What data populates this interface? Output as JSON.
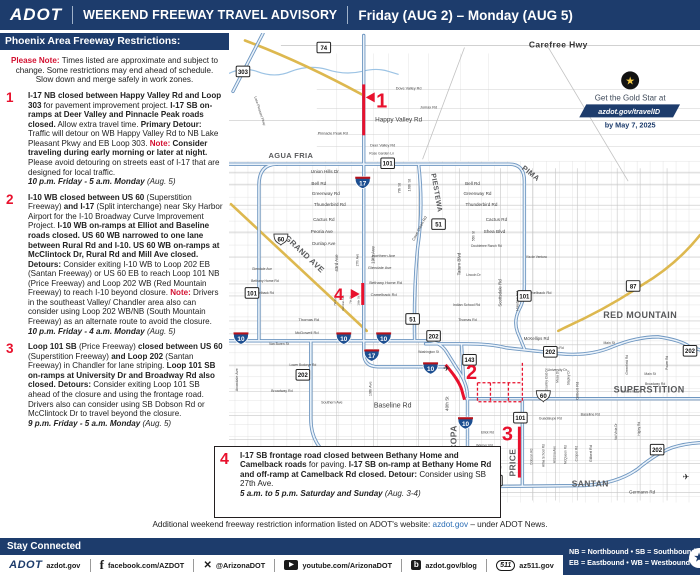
{
  "colors": {
    "navy": "#1d3c6c",
    "red": "#d31232",
    "marker_red": "#e8112d",
    "link_blue": "#2a6db5",
    "freeway_blue": "#6e96c0",
    "yellow_road": "#ddb84f",
    "interstate_blue": "#1d4f91"
  },
  "header": {
    "logo": "ADOT",
    "title": "WEEKEND FREEWAY TRAVEL ADVISORY",
    "dates": "Friday (AUG 2) – Monday (AUG 5)"
  },
  "panel": {
    "title": "Phoenix Area Freeway Restrictions:",
    "note": [
      {
        "t": "Please Note: ",
        "s": "rb"
      },
      {
        "t": "Times listed are approximate and subject to change. Some restrictions may end ahead of schedule. Slow down and merge safely in work zones.",
        "s": "n"
      }
    ],
    "items": [
      {
        "num": "1",
        "segments": [
          {
            "t": "I-17 NB closed between Happy Valley Rd and Loop 303",
            "s": "b"
          },
          {
            "t": " for pavement improvement project. ",
            "s": "n"
          },
          {
            "t": "I-17 SB on-ramps at Deer Valley and Pinnacle Peak roads closed.",
            "s": "b"
          },
          {
            "t": " Allow extra travel time. ",
            "s": "n"
          },
          {
            "t": "Primary Detour:",
            "s": "b"
          },
          {
            "t": " Traffic will detour on WB Happy Valley Rd to NB Lake Pleasant Pkwy and EB Loop 303. ",
            "s": "n"
          },
          {
            "t": "Note:",
            "s": "rb"
          },
          {
            "t": " ",
            "s": "n"
          },
          {
            "t": "Consider traveling during early morning or later at night.",
            "s": "b"
          },
          {
            "t": " Please avoid detouring on streets east of I-17 that are designed for local traffic.",
            "s": "n"
          },
          {
            "br": true
          },
          {
            "t": "10 p.m. Friday - 5 a.m. Monday",
            "s": "ib"
          },
          {
            "t": " (Aug. 5)",
            "s": "i"
          }
        ]
      },
      {
        "num": "2",
        "segments": [
          {
            "t": "I-10 WB closed between US 60",
            "s": "b"
          },
          {
            "t": " (Superstition Freeway) ",
            "s": "n"
          },
          {
            "t": "and I-17",
            "s": "b"
          },
          {
            "t": " (Split interchange) near Sky Harbor Airport for the I-10 Broadway Curve Improvement Project. ",
            "s": "n"
          },
          {
            "t": "I-10 WB on-ramps at Elliot and Baseline roads closed. US 60 WB narrowed to one lane between Rural Rd and I-10. US 60 WB on-ramps at McClintock Dr, Rural Rd and Mill Ave closed. Detours:",
            "s": "b"
          },
          {
            "t": " Consider exiting I-10 WB to Loop 202 EB (Santan Freeway) or US 60 EB to reach Loop 101 NB (Price Freeway) and Loop 202 WB (Red Mountain Freeway) to reach I-10 beyond closure. ",
            "s": "n"
          },
          {
            "t": "Note:",
            "s": "rb"
          },
          {
            "t": " Drivers in the southeast Valley/ Chandler area also can consider using Loop 202 WB/NB (South Mountain Freeway) as an alternate route to avoid the closure.",
            "s": "n"
          },
          {
            "br": true
          },
          {
            "t": "10 p.m. Friday - 4 a.m. Monday",
            "s": "ib"
          },
          {
            "t": " (Aug. 5)",
            "s": "i"
          }
        ]
      },
      {
        "num": "3",
        "segments": [
          {
            "t": "Loop 101 SB",
            "s": "b"
          },
          {
            "t": " (Price Freeway) ",
            "s": "n"
          },
          {
            "t": "closed between US 60",
            "s": "b"
          },
          {
            "t": " (Superstition Freeway) ",
            "s": "n"
          },
          {
            "t": "and Loop 202",
            "s": "b"
          },
          {
            "t": " (Santan Freeway) in Chandler for lane striping. ",
            "s": "n"
          },
          {
            "t": "Loop 101 SB on-ramps at University Dr and Broadway Rd also closed. ",
            "s": "b"
          },
          {
            "t": "Detours:",
            "s": "b"
          },
          {
            "t": " Consider exiting Loop 101 SB ahead of the closure and using the frontage road. Drivers also can consider using SB Dobson Rd or McClintock Dr to travel beyond the closure.",
            "s": "n"
          },
          {
            "br": true
          },
          {
            "t": "9 p.m. Friday - 5 a.m. Monday",
            "s": "ib"
          },
          {
            "t": " (Aug. 5)",
            "s": "i"
          }
        ]
      }
    ]
  },
  "map": {
    "callout4": {
      "num": "4",
      "segments": [
        {
          "t": "I-17 SB frontage road closed between Bethany Home and Camelback roads",
          "s": "b"
        },
        {
          "t": " for paving. ",
          "s": "n"
        },
        {
          "t": "I-17 SB on-ramp at Bethany Home Rd and off-ramp at Camelback Rd closed. Detour:",
          "s": "b"
        },
        {
          "t": " Consider using SB 27th Ave.",
          "s": "n"
        },
        {
          "br": true
        },
        {
          "t": "5 a.m. to 5 p.m. Saturday and Sunday",
          "s": "ib"
        },
        {
          "t": " (Aug. 3-4)",
          "s": "i"
        }
      ]
    },
    "goldstar": {
      "star": "★",
      "line1": "Get the Gold Star at",
      "line2": "azdot.gov/travelID",
      "line3": "by May 7, 2025"
    },
    "freeway_names": [
      {
        "t": "Carefree Hwy",
        "x": 330,
        "y": 14,
        "fs": 8.5,
        "c": "#333333"
      },
      {
        "t": "AGUA FRIA",
        "x": 62,
        "y": 125,
        "fs": 7.5
      },
      {
        "t": "PIMA",
        "x": 301,
        "y": 142,
        "r": 38,
        "fs": 7.5
      },
      {
        "t": "PIESTEWA",
        "x": 206,
        "y": 160,
        "r": 80,
        "fs": 7
      },
      {
        "t": "RED MOUNTAIN",
        "x": 412,
        "y": 285,
        "fs": 9
      },
      {
        "t": "SUPERSTITION",
        "x": 421,
        "y": 360,
        "fs": 9
      },
      {
        "t": "SANTAN",
        "x": 362,
        "y": 454,
        "fs": 8.5
      },
      {
        "t": "MARICOPA",
        "x": 228,
        "y": 417,
        "r": -90,
        "fs": 8.5
      },
      {
        "t": "PRICE",
        "x": 287,
        "y": 430,
        "r": -90,
        "fs": 8.5
      },
      {
        "t": "GRAND AVE",
        "x": 74,
        "y": 223,
        "r": 43,
        "fs": 8
      }
    ],
    "street_labels": [
      {
        "t": "Dove Valley Rd",
        "x": 180,
        "y": 56,
        "fs": 3.8
      },
      {
        "t": "Jomax Rd",
        "x": 200,
        "y": 75,
        "fs": 3.8
      },
      {
        "t": "Happy Valley Rd",
        "x": 170,
        "y": 88,
        "fs": 6.4
      },
      {
        "t": "Pinnacle Peak Rd",
        "x": 104,
        "y": 101,
        "fs": 3.8
      },
      {
        "t": "Deer Valley Rd",
        "x": 154,
        "y": 113,
        "fs": 3.8
      },
      {
        "t": "Rose Garden Ln",
        "x": 153,
        "y": 121,
        "fs": 3.4
      },
      {
        "t": "Lake Pleasant Pkwy",
        "x": 30,
        "y": 78,
        "r": 72,
        "fs": 3.4
      },
      {
        "t": "Union Hills Dr",
        "x": 96,
        "y": 140,
        "fs": 4.6
      },
      {
        "t": "Bell Rd",
        "x": 90,
        "y": 152,
        "fs": 4.6
      },
      {
        "t": "Greenway Rd",
        "x": 97,
        "y": 162,
        "fs": 4.6
      },
      {
        "t": "Thunderbird Rd",
        "x": 101,
        "y": 173,
        "fs": 4.6
      },
      {
        "t": "Cactus Rd",
        "x": 95,
        "y": 188,
        "fs": 4.6
      },
      {
        "t": "Peoria Ave",
        "x": 93,
        "y": 200,
        "fs": 4.6
      },
      {
        "t": "Dunlap Ave",
        "x": 95,
        "y": 212,
        "fs": 4.6
      },
      {
        "t": "Bell Rd",
        "x": 244,
        "y": 152,
        "fs": 4.6
      },
      {
        "t": "Greenway Rd",
        "x": 249,
        "y": 162,
        "fs": 4.6
      },
      {
        "t": "Thunderbird Rd",
        "x": 253,
        "y": 173,
        "fs": 4.6
      },
      {
        "t": "Cactus Rd",
        "x": 268,
        "y": 188,
        "fs": 4.6
      },
      {
        "t": "Shea Blvd",
        "x": 266,
        "y": 200,
        "fs": 4.8
      },
      {
        "t": "Doubletree Ranch Rd",
        "x": 258,
        "y": 214,
        "fs": 3.2
      },
      {
        "t": "Via de Ventura",
        "x": 308,
        "y": 225,
        "fs": 3.2
      },
      {
        "t": "Lincoln Dr",
        "x": 245,
        "y": 243,
        "fs": 3.2
      },
      {
        "t": "Northern Ave",
        "x": 155,
        "y": 224,
        "fs": 4
      },
      {
        "t": "Glendale Ave",
        "x": 151,
        "y": 236,
        "fs": 4
      },
      {
        "t": "Glendale Ave",
        "x": 33,
        "y": 237,
        "fs": 3.4
      },
      {
        "t": "Bethany Home Rd",
        "x": 157,
        "y": 251,
        "fs": 4
      },
      {
        "t": "Bethany Home Rd",
        "x": 36,
        "y": 249,
        "fs": 3.4
      },
      {
        "t": "Camelback Rd",
        "x": 155,
        "y": 263,
        "fs": 4
      },
      {
        "t": "Camelback Rd",
        "x": 34,
        "y": 261,
        "fs": 3.4
      },
      {
        "t": "Camelback Rd",
        "x": 310,
        "y": 261,
        "fs": 4
      },
      {
        "t": "Indian School Rd",
        "x": 238,
        "y": 273,
        "fs": 3.6
      },
      {
        "t": "Thomas Rd",
        "x": 80,
        "y": 288,
        "fs": 4
      },
      {
        "t": "Thomas Rd",
        "x": 239,
        "y": 288,
        "fs": 3.6
      },
      {
        "t": "McDowell Rd",
        "x": 78,
        "y": 301,
        "fs": 4
      },
      {
        "t": "Van Buren St",
        "x": 50,
        "y": 312,
        "fs": 3.4
      },
      {
        "t": "Washington St",
        "x": 200,
        "y": 320,
        "fs": 3.2
      },
      {
        "t": "Lower Buckeye Rd",
        "x": 74,
        "y": 333,
        "fs": 3.2
      },
      {
        "t": "Broadway Rd",
        "x": 53,
        "y": 359,
        "fs": 3.6
      },
      {
        "t": "Southern Ave",
        "x": 103,
        "y": 371,
        "fs": 3.6
      },
      {
        "t": "Baseline Rd",
        "x": 164,
        "y": 375,
        "fs": 7
      },
      {
        "t": "Baseline Rd",
        "x": 362,
        "y": 383,
        "fs": 3.6
      },
      {
        "t": "Guadalupe Rd",
        "x": 322,
        "y": 387,
        "fs": 3.6
      },
      {
        "t": "Elliot Rd",
        "x": 259,
        "y": 401,
        "fs": 3.5
      },
      {
        "t": "Warner Rd",
        "x": 256,
        "y": 414,
        "fs": 3.5
      },
      {
        "t": "Ray Rd",
        "x": 254,
        "y": 424,
        "fs": 3.5
      },
      {
        "t": "Chandler Blvd",
        "x": 262,
        "y": 436,
        "fs": 3.5
      },
      {
        "t": "Germann Rd",
        "x": 414,
        "y": 461,
        "fs": 4.6
      },
      {
        "t": "McKellips Rd",
        "x": 308,
        "y": 307,
        "fs": 4.4
      },
      {
        "t": "Brown Rd",
        "x": 328,
        "y": 316,
        "fs": 3.4
      },
      {
        "t": "University Dr",
        "x": 329,
        "y": 338,
        "fs": 3.4
      },
      {
        "t": "Main St",
        "x": 381,
        "y": 311,
        "fs": 3.4
      },
      {
        "t": "Main St",
        "x": 422,
        "y": 342,
        "fs": 3.4
      },
      {
        "t": "Broadway Rd",
        "x": 427,
        "y": 352,
        "fs": 3.4
      },
      {
        "t": "Southern Ave",
        "x": 403,
        "y": 360,
        "fs": 3.4
      },
      {
        "t": "Wild Horse Pass Blvd",
        "x": 62,
        "y": 461,
        "fs": 3.2
      },
      {
        "t": "19th Ave",
        "x": 146,
        "y": 222,
        "r": -90,
        "fs": 4.6
      },
      {
        "t": "19th Ave",
        "x": 143,
        "y": 356,
        "r": -90,
        "fs": 3.8
      },
      {
        "t": "7th St",
        "x": 172,
        "y": 155,
        "r": -90,
        "fs": 4
      },
      {
        "t": "16th St",
        "x": 182,
        "y": 152,
        "r": -90,
        "fs": 4
      },
      {
        "t": "Cave Creek Rd",
        "x": 192,
        "y": 196,
        "r": -62,
        "fs": 4
      },
      {
        "t": "Tatum Blvd",
        "x": 232,
        "y": 231,
        "r": -90,
        "fs": 4.6
      },
      {
        "t": "Scottsdale Rd",
        "x": 273,
        "y": 260,
        "r": -90,
        "fs": 4.4
      },
      {
        "t": "Hayden Rd",
        "x": 290,
        "y": 268,
        "r": -90,
        "fs": 4
      },
      {
        "t": "40th St",
        "x": 220,
        "y": 371,
        "r": -90,
        "fs": 4.6
      },
      {
        "t": "43rd Ave",
        "x": 109,
        "y": 230,
        "r": -90,
        "fs": 4.4
      },
      {
        "t": "27th Ave",
        "x": 130,
        "y": 227,
        "r": -90,
        "fs": 3.2
      },
      {
        "t": "7th Ave",
        "x": 107,
        "y": 268,
        "r": -90,
        "fs": 3
      },
      {
        "t": "Central Ave",
        "x": 115,
        "y": 270,
        "r": -90,
        "fs": 3
      },
      {
        "t": "7th St",
        "x": 123,
        "y": 267,
        "r": -90,
        "fs": 3
      },
      {
        "t": "16th St",
        "x": 131,
        "y": 268,
        "r": -90,
        "fs": 3
      },
      {
        "t": "Avondale Ave",
        "x": 9,
        "y": 347,
        "r": -90,
        "fs": 3.8
      },
      {
        "t": "56th St",
        "x": 246,
        "y": 203,
        "r": -90,
        "fs": 3.2
      },
      {
        "t": "Country Club Dr",
        "x": 319,
        "y": 347,
        "r": -90,
        "fs": 3.2
      },
      {
        "t": "Mesa Dr",
        "x": 330,
        "y": 344,
        "r": -90,
        "fs": 3.2
      },
      {
        "t": "Stapley Dr",
        "x": 341,
        "y": 345,
        "r": -90,
        "fs": 3.2
      },
      {
        "t": "Gilbert Rd",
        "x": 350,
        "y": 358,
        "r": -90,
        "fs": 4
      },
      {
        "t": "Gilbert Rd",
        "x": 364,
        "y": 421,
        "r": -90,
        "fs": 3.8
      },
      {
        "t": "Dobson Rd",
        "x": 304,
        "y": 424,
        "r": -90,
        "fs": 3.2
      },
      {
        "t": "Alma School Rd",
        "x": 316,
        "y": 423,
        "r": -90,
        "fs": 3.2
      },
      {
        "t": "Arizona Ave",
        "x": 327,
        "y": 422,
        "r": -90,
        "fs": 3.2
      },
      {
        "t": "McQueen Rd",
        "x": 338,
        "y": 422,
        "r": -90,
        "fs": 3.2
      },
      {
        "t": "Cooper Rd",
        "x": 349,
        "y": 421,
        "r": -90,
        "fs": 3.2
      },
      {
        "t": "Val Vista Dr",
        "x": 389,
        "y": 399,
        "r": -90,
        "fs": 3.2
      },
      {
        "t": "Higley Rd",
        "x": 412,
        "y": 396,
        "r": -90,
        "fs": 3.2
      },
      {
        "t": "Power Rd",
        "x": 440,
        "y": 330,
        "r": -90,
        "fs": 3.2
      },
      {
        "t": "Greenfield Rd",
        "x": 400,
        "y": 332,
        "r": -90,
        "fs": 3.2
      }
    ],
    "shields": [
      {
        "k": "sr",
        "n": "74",
        "x": 95,
        "y": 14
      },
      {
        "k": "sr",
        "n": "303",
        "x": 14,
        "y": 38
      },
      {
        "k": "sr",
        "n": "101",
        "x": 159,
        "y": 130
      },
      {
        "k": "sr",
        "n": "101",
        "x": 23,
        "y": 260
      },
      {
        "k": "sr",
        "n": "101",
        "x": 296,
        "y": 263
      },
      {
        "k": "sr",
        "n": "101",
        "x": 292,
        "y": 385
      },
      {
        "k": "i",
        "n": "17",
        "x": 134,
        "y": 149
      },
      {
        "k": "i",
        "n": "17",
        "x": 143,
        "y": 322
      },
      {
        "k": "sr",
        "n": "51",
        "x": 210,
        "y": 191
      },
      {
        "k": "sr",
        "n": "51",
        "x": 184,
        "y": 286
      },
      {
        "k": "i",
        "n": "10",
        "x": 12,
        "y": 305
      },
      {
        "k": "i",
        "n": "10",
        "x": 115,
        "y": 305
      },
      {
        "k": "i",
        "n": "10",
        "x": 155,
        "y": 305
      },
      {
        "k": "i",
        "n": "10",
        "x": 202,
        "y": 335
      },
      {
        "k": "i",
        "n": "10",
        "x": 237,
        "y": 390
      },
      {
        "k": "sr",
        "n": "202",
        "x": 205,
        "y": 303
      },
      {
        "k": "sr",
        "n": "202",
        "x": 322,
        "y": 319
      },
      {
        "k": "sr",
        "n": "202",
        "x": 462,
        "y": 318
      },
      {
        "k": "sr",
        "n": "202",
        "x": 74,
        "y": 342
      },
      {
        "k": "sr",
        "n": "202",
        "x": 267,
        "y": 448
      },
      {
        "k": "sr",
        "n": "202",
        "x": 429,
        "y": 417
      },
      {
        "k": "sr",
        "n": "143",
        "x": 241,
        "y": 327
      },
      {
        "k": "us",
        "n": "60",
        "x": 52,
        "y": 206
      },
      {
        "k": "us",
        "n": "60",
        "x": 315,
        "y": 363
      },
      {
        "k": "sr",
        "n": "87",
        "x": 405,
        "y": 253
      }
    ],
    "markers": [
      {
        "n": "1",
        "x": 153,
        "y": 74,
        "fs": 20,
        "tri": "137,64 146,59 146,69"
      },
      {
        "n": "2",
        "x": 243,
        "y": 346,
        "fs": 20
      },
      {
        "n": "3",
        "x": 279,
        "y": 408,
        "fs": 20
      },
      {
        "n": "4",
        "x": 110,
        "y": 267,
        "fs": 17,
        "tri": "131,261 122,256 122,266"
      }
    ],
    "airplanes": [
      {
        "x": 218,
        "y": 338
      },
      {
        "x": 458,
        "y": 447
      }
    ]
  },
  "footer_note": [
    {
      "t": "Additional weekend freeway restriction information listed on ADOT's website: ",
      "s": "n"
    },
    {
      "t": "azdot.gov",
      "s": "link"
    },
    {
      "t": " – under ADOT News.",
      "s": "n"
    }
  ],
  "footer": {
    "stay": "Stay Connected",
    "links": [
      {
        "icon": "adot-logo",
        "label": "azdot.gov"
      },
      {
        "icon": "facebook",
        "label": "facebook.com/AZDOT"
      },
      {
        "icon": "x-twitter",
        "label": "@ArizonaDOT"
      },
      {
        "icon": "youtube",
        "label": "youtube.com/ArizonaDOT"
      },
      {
        "icon": "blog",
        "label": "azdot.gov/blog"
      },
      {
        "icon": "az511",
        "label": "az511.gov"
      }
    ],
    "legend_line1": "NB = Northbound  •  SB = Southbound",
    "legend_line2": "EB = Eastbound  •  WB = Westbound"
  }
}
